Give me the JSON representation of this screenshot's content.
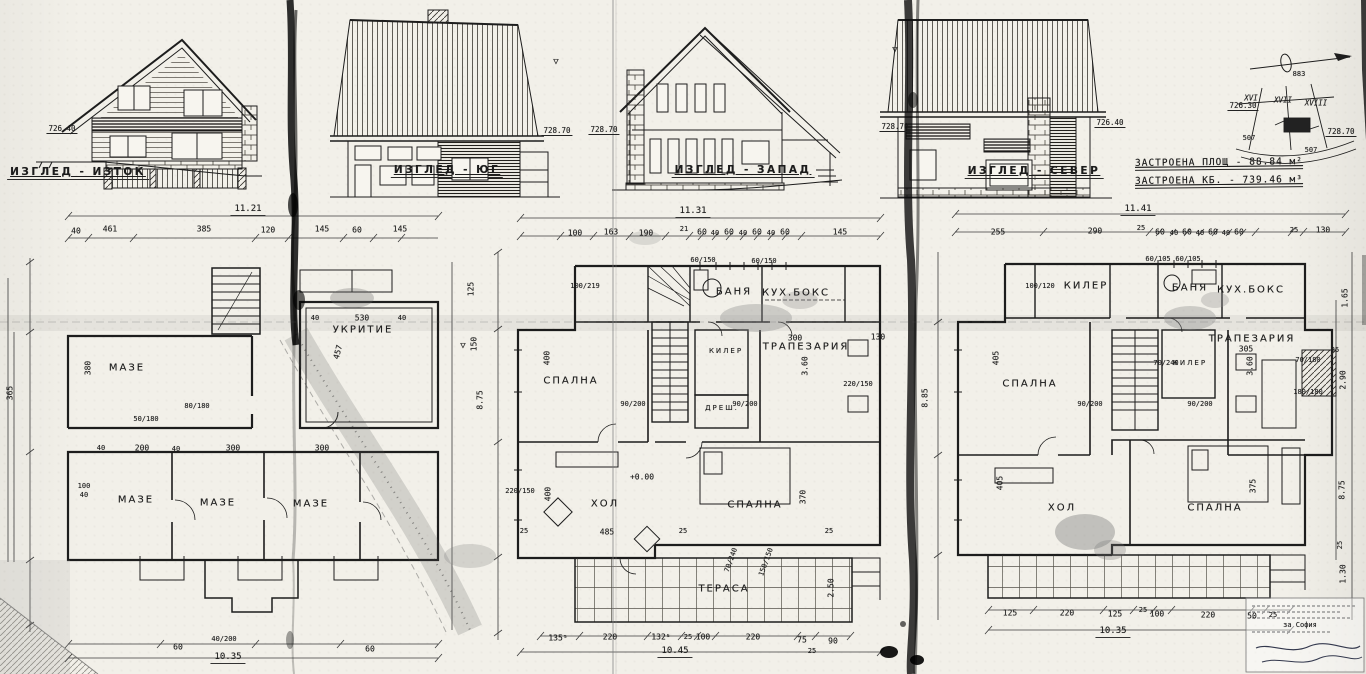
{
  "site_info": {
    "area_line": "ЗАСТРОЕНА ПЛОЩ - 88.84 м²",
    "volume_line": "ЗАСТРОЕНА КБ. - 739.46 м³"
  },
  "ink": "#1b1b1b",
  "labels": [
    {
      "t": "ИЗГЛЕД - ИЗТОК",
      "x": 78,
      "y": 173,
      "k": "view",
      "n": "view-label-east"
    },
    {
      "t": "ИЗГЛЕД - ЮГ",
      "x": 447,
      "y": 171,
      "k": "view",
      "n": "view-label-south"
    },
    {
      "t": "ИЗГЛЕД - ЗАПАД",
      "x": 743,
      "y": 171,
      "k": "view",
      "n": "view-label-west"
    },
    {
      "t": "ИЗГЛЕД - СЕВЕР",
      "x": 1034,
      "y": 172,
      "k": "view",
      "n": "view-label-north"
    },
    {
      "t": "726.40",
      "x": 62,
      "y": 129,
      "k": "lvl",
      "n": "level-mark"
    },
    {
      "t": "728.70",
      "x": 557,
      "y": 131,
      "k": "lvl",
      "n": "level-mark"
    },
    {
      "t": "728.70",
      "x": 604,
      "y": 130,
      "k": "lvl",
      "n": "level-mark"
    },
    {
      "t": "728.70",
      "x": 895,
      "y": 127,
      "k": "lvl",
      "n": "level-mark"
    },
    {
      "t": "726.40",
      "x": 1110,
      "y": 123,
      "k": "lvl",
      "n": "level-mark"
    },
    {
      "t": "726.30",
      "x": 1243,
      "y": 106,
      "k": "lvl",
      "n": "level-mark"
    },
    {
      "t": "728.70",
      "x": 1341,
      "y": 132,
      "k": "lvl",
      "n": "level-mark"
    },
    {
      "t": "▽",
      "x": 556,
      "y": 62,
      "k": "sym",
      "n": "level-symbol"
    },
    {
      "t": "▽",
      "x": 895,
      "y": 50,
      "k": "sym",
      "n": "level-symbol"
    },
    {
      "t": "▽",
      "x": 463,
      "y": 346,
      "k": "sym",
      "n": "level-symbol"
    },
    {
      "t": "XVI",
      "x": 1251,
      "y": 98,
      "k": "parcel",
      "n": "parcel-number"
    },
    {
      "t": "XVII",
      "x": 1283,
      "y": 100,
      "k": "parcel",
      "n": "parcel-number"
    },
    {
      "t": "XVIII",
      "x": 1316,
      "y": 103,
      "k": "parcel",
      "n": "parcel-number"
    },
    {
      "t": "883",
      "x": 1299,
      "y": 74,
      "k": "tiny",
      "n": "site-number"
    },
    {
      "t": "507",
      "x": 1249,
      "y": 138,
      "k": "tiny",
      "n": "plot-number"
    },
    {
      "t": "507",
      "x": 1311,
      "y": 150,
      "k": "tiny",
      "n": "plot-number"
    },
    {
      "t": "МАЗЕ",
      "x": 127,
      "y": 368,
      "k": "room",
      "n": "room-label"
    },
    {
      "t": "МАЗЕ",
      "x": 136,
      "y": 500,
      "k": "room",
      "n": "room-label"
    },
    {
      "t": "МАЗЕ",
      "x": 218,
      "y": 503,
      "k": "room",
      "n": "room-label"
    },
    {
      "t": "МАЗЕ",
      "x": 311,
      "y": 504,
      "k": "room",
      "n": "room-label"
    },
    {
      "t": "УКРИТИЕ",
      "x": 363,
      "y": 330,
      "k": "room",
      "n": "room-label"
    },
    {
      "t": "СПАЛНА",
      "x": 571,
      "y": 381,
      "k": "room",
      "n": "room-label"
    },
    {
      "t": "БАНЯ",
      "x": 734,
      "y": 292,
      "k": "room",
      "n": "room-label"
    },
    {
      "t": "КУХ.БОКС",
      "x": 796,
      "y": 293,
      "k": "room",
      "n": "room-label"
    },
    {
      "t": "ТРАПЕЗАРИЯ",
      "x": 806,
      "y": 347,
      "k": "room",
      "n": "room-label"
    },
    {
      "t": "КИЛЕР",
      "x": 726,
      "y": 351,
      "s": 7,
      "k": "room",
      "n": "room-label"
    },
    {
      "t": "ДРЕШ.",
      "x": 722,
      "y": 408,
      "s": 7,
      "k": "room",
      "n": "room-label"
    },
    {
      "t": "ХОЛ",
      "x": 605,
      "y": 504,
      "k": "room",
      "n": "room-label"
    },
    {
      "t": "СПАЛНА",
      "x": 755,
      "y": 505,
      "k": "room",
      "n": "room-label"
    },
    {
      "t": "ТЕРАСА",
      "x": 724,
      "y": 589,
      "k": "room",
      "n": "room-label"
    },
    {
      "t": "+0.00",
      "x": 642,
      "y": 477,
      "k": "dim",
      "n": "elevation-mark"
    },
    {
      "t": "КИЛЕР",
      "x": 1086,
      "y": 286,
      "k": "room",
      "n": "room-label"
    },
    {
      "t": "БАНЯ",
      "x": 1190,
      "y": 288,
      "k": "room",
      "n": "room-label"
    },
    {
      "t": "КУХ.БОКС",
      "x": 1251,
      "y": 290,
      "k": "room",
      "n": "room-label"
    },
    {
      "t": "СПАЛНА",
      "x": 1030,
      "y": 384,
      "k": "room",
      "n": "room-label"
    },
    {
      "t": "ТРАПЕЗАРИЯ",
      "x": 1252,
      "y": 339,
      "k": "room",
      "n": "room-label"
    },
    {
      "t": "КИЛЕР",
      "x": 1190,
      "y": 363,
      "s": 7,
      "k": "room",
      "n": "room-label"
    },
    {
      "t": "ХОЛ",
      "x": 1062,
      "y": 508,
      "k": "room",
      "n": "room-label"
    },
    {
      "t": "СПАЛНА",
      "x": 1215,
      "y": 508,
      "k": "room",
      "n": "room-label"
    },
    {
      "t": "11.21",
      "x": 248,
      "y": 210,
      "k": "total",
      "n": "overall-dim"
    },
    {
      "t": "10.35",
      "x": 228,
      "y": 658,
      "k": "total",
      "n": "overall-dim"
    },
    {
      "t": "11.31",
      "x": 693,
      "y": 212,
      "k": "total",
      "n": "overall-dim"
    },
    {
      "t": "10.45",
      "x": 675,
      "y": 652,
      "k": "total",
      "n": "overall-dim"
    },
    {
      "t": "11.41",
      "x": 1138,
      "y": 210,
      "k": "total",
      "n": "overall-dim"
    },
    {
      "t": "10.35",
      "x": 1113,
      "y": 632,
      "k": "total",
      "n": "overall-dim"
    },
    {
      "t": "40",
      "x": 76,
      "y": 231,
      "k": "dim",
      "n": "dim"
    },
    {
      "t": "461",
      "x": 110,
      "y": 229,
      "k": "dim",
      "n": "dim"
    },
    {
      "t": "385",
      "x": 204,
      "y": 229,
      "k": "dim",
      "n": "dim"
    },
    {
      "t": "120",
      "x": 268,
      "y": 230,
      "k": "dim",
      "n": "dim"
    },
    {
      "t": "145",
      "x": 322,
      "y": 229,
      "k": "dim",
      "n": "dim"
    },
    {
      "t": "60",
      "x": 357,
      "y": 230,
      "k": "dim",
      "n": "dim"
    },
    {
      "t": "145",
      "x": 400,
      "y": 229,
      "k": "dim",
      "n": "dim"
    },
    {
      "t": "365",
      "x": 10,
      "y": 393,
      "r": -90,
      "k": "dim",
      "n": "dim"
    },
    {
      "t": "380",
      "x": 88,
      "y": 368,
      "r": -90,
      "k": "dim",
      "n": "dim"
    },
    {
      "t": "100",
      "x": 84,
      "y": 486,
      "s": 7,
      "k": "dim",
      "n": "dim"
    },
    {
      "t": "40",
      "x": 84,
      "y": 495,
      "s": 7,
      "k": "dim",
      "n": "dim"
    },
    {
      "t": "40",
      "x": 101,
      "y": 448,
      "s": 7,
      "k": "dim",
      "n": "dim"
    },
    {
      "t": "200",
      "x": 142,
      "y": 448,
      "k": "dim",
      "n": "dim"
    },
    {
      "t": "40",
      "x": 176,
      "y": 449,
      "s": 7,
      "k": "dim",
      "n": "dim"
    },
    {
      "t": "300",
      "x": 233,
      "y": 448,
      "k": "dim",
      "n": "dim"
    },
    {
      "t": "300",
      "x": 322,
      "y": 448,
      "k": "dim",
      "n": "dim"
    },
    {
      "t": "80/180",
      "x": 197,
      "y": 406,
      "k": "frac",
      "n": "dim"
    },
    {
      "t": "50/180",
      "x": 146,
      "y": 419,
      "k": "frac",
      "n": "dim"
    },
    {
      "t": "457",
      "x": 338,
      "y": 352,
      "r": -75,
      "k": "dim",
      "n": "dim"
    },
    {
      "t": "40",
      "x": 315,
      "y": 318,
      "s": 7,
      "k": "dim",
      "n": "dim"
    },
    {
      "t": "530",
      "x": 362,
      "y": 318,
      "k": "dim",
      "n": "dim"
    },
    {
      "t": "40",
      "x": 402,
      "y": 318,
      "s": 7,
      "k": "dim",
      "n": "dim"
    },
    {
      "t": "125",
      "x": 471,
      "y": 289,
      "r": -90,
      "k": "dim",
      "n": "dim"
    },
    {
      "t": "150",
      "x": 474,
      "y": 344,
      "r": -90,
      "k": "dim",
      "n": "dim"
    },
    {
      "t": "60",
      "x": 178,
      "y": 647,
      "k": "dim",
      "n": "dim"
    },
    {
      "t": "40/200",
      "x": 224,
      "y": 639,
      "k": "frac",
      "n": "dim"
    },
    {
      "t": "60",
      "x": 370,
      "y": 649,
      "k": "dim",
      "n": "dim"
    },
    {
      "t": "100",
      "x": 575,
      "y": 233,
      "k": "dim",
      "n": "dim"
    },
    {
      "t": "163",
      "x": 611,
      "y": 232,
      "k": "dim",
      "n": "dim"
    },
    {
      "t": "190",
      "x": 646,
      "y": 233,
      "k": "dim",
      "n": "dim"
    },
    {
      "t": "21",
      "x": 684,
      "y": 229,
      "s": 7,
      "k": "dim",
      "n": "dim"
    },
    {
      "t": "60",
      "x": 702,
      "y": 232,
      "k": "dim",
      "n": "dim"
    },
    {
      "t": "40",
      "x": 715,
      "y": 233,
      "s": 7,
      "k": "dim",
      "n": "dim"
    },
    {
      "t": "60",
      "x": 729,
      "y": 232,
      "k": "dim",
      "n": "dim"
    },
    {
      "t": "40",
      "x": 743,
      "y": 233,
      "s": 7,
      "k": "dim",
      "n": "dim"
    },
    {
      "t": "60",
      "x": 757,
      "y": 232,
      "k": "dim",
      "n": "dim"
    },
    {
      "t": "40",
      "x": 771,
      "y": 233,
      "s": 7,
      "k": "dim",
      "n": "dim"
    },
    {
      "t": "60",
      "x": 785,
      "y": 232,
      "k": "dim",
      "n": "dim"
    },
    {
      "t": "145",
      "x": 840,
      "y": 232,
      "k": "dim",
      "n": "dim"
    },
    {
      "t": "8.75",
      "x": 480,
      "y": 400,
      "r": -90,
      "k": "dim",
      "n": "dim"
    },
    {
      "t": "100/219",
      "x": 585,
      "y": 286,
      "k": "frac",
      "n": "dim"
    },
    {
      "t": "400",
      "x": 547,
      "y": 358,
      "r": -90,
      "k": "dim",
      "n": "dim"
    },
    {
      "t": "300",
      "x": 795,
      "y": 338,
      "k": "dim",
      "n": "dim"
    },
    {
      "t": "130",
      "x": 878,
      "y": 337,
      "k": "dim",
      "n": "dim"
    },
    {
      "t": "220/150",
      "x": 858,
      "y": 384,
      "k": "frac",
      "n": "dim"
    },
    {
      "t": "3.60",
      "x": 805,
      "y": 366,
      "r": -90,
      "k": "dim",
      "n": "dim"
    },
    {
      "t": "90/200",
      "x": 633,
      "y": 404,
      "k": "frac",
      "n": "dim"
    },
    {
      "t": "90/200",
      "x": 745,
      "y": 404,
      "k": "frac",
      "n": "dim"
    },
    {
      "t": "220/150",
      "x": 520,
      "y": 491,
      "k": "frac",
      "n": "dim"
    },
    {
      "t": "400",
      "x": 548,
      "y": 494,
      "r": -90,
      "k": "dim",
      "n": "dim"
    },
    {
      "t": "485",
      "x": 607,
      "y": 532,
      "k": "dim",
      "n": "dim"
    },
    {
      "t": "25",
      "x": 524,
      "y": 531,
      "s": 7,
      "k": "dim",
      "n": "dim"
    },
    {
      "t": "25",
      "x": 683,
      "y": 531,
      "s": 7,
      "k": "dim",
      "n": "dim"
    },
    {
      "t": "25",
      "x": 829,
      "y": 531,
      "s": 7,
      "k": "dim",
      "n": "dim"
    },
    {
      "t": "370",
      "x": 803,
      "y": 497,
      "r": -90,
      "k": "dim",
      "n": "dim"
    },
    {
      "t": "2.50",
      "x": 831,
      "y": 588,
      "r": -90,
      "k": "dim",
      "n": "dim"
    },
    {
      "t": "70/240",
      "x": 731,
      "y": 560,
      "r": -70,
      "k": "frac",
      "n": "dim"
    },
    {
      "t": "150/150",
      "x": 766,
      "y": 562,
      "r": -70,
      "k": "frac",
      "n": "dim"
    },
    {
      "t": "60/150",
      "x": 703,
      "y": 260,
      "k": "frac",
      "n": "dim"
    },
    {
      "t": "60/150",
      "x": 764,
      "y": 261,
      "k": "frac",
      "n": "dim"
    },
    {
      "t": "135⁵",
      "x": 558,
      "y": 638,
      "k": "dim",
      "n": "dim"
    },
    {
      "t": "220",
      "x": 610,
      "y": 637,
      "k": "dim",
      "n": "dim"
    },
    {
      "t": "132⁵",
      "x": 661,
      "y": 637,
      "k": "dim",
      "n": "dim"
    },
    {
      "t": "25",
      "x": 688,
      "y": 637,
      "s": 7,
      "k": "dim",
      "n": "dim"
    },
    {
      "t": "100",
      "x": 703,
      "y": 637,
      "k": "dim",
      "n": "dim"
    },
    {
      "t": "220",
      "x": 753,
      "y": 637,
      "k": "dim",
      "n": "dim"
    },
    {
      "t": "75",
      "x": 802,
      "y": 640,
      "k": "dim",
      "n": "dim"
    },
    {
      "t": "90",
      "x": 833,
      "y": 641,
      "k": "dim",
      "n": "dim"
    },
    {
      "t": "25",
      "x": 812,
      "y": 651,
      "s": 7,
      "k": "dim",
      "n": "dim"
    },
    {
      "t": "255",
      "x": 998,
      "y": 232,
      "k": "dim",
      "n": "dim"
    },
    {
      "t": "290",
      "x": 1095,
      "y": 231,
      "k": "dim",
      "n": "dim"
    },
    {
      "t": "25",
      "x": 1141,
      "y": 228,
      "s": 7,
      "k": "dim",
      "n": "dim"
    },
    {
      "t": "60",
      "x": 1160,
      "y": 232,
      "k": "dim",
      "n": "dim"
    },
    {
      "t": "40",
      "x": 1174,
      "y": 233,
      "s": 7,
      "k": "dim",
      "n": "dim"
    },
    {
      "t": "60",
      "x": 1187,
      "y": 232,
      "k": "dim",
      "n": "dim"
    },
    {
      "t": "40",
      "x": 1200,
      "y": 233,
      "s": 7,
      "k": "dim",
      "n": "dim"
    },
    {
      "t": "60",
      "x": 1213,
      "y": 232,
      "k": "dim",
      "n": "dim"
    },
    {
      "t": "40",
      "x": 1226,
      "y": 233,
      "s": 7,
      "k": "dim",
      "n": "dim"
    },
    {
      "t": "60",
      "x": 1239,
      "y": 232,
      "k": "dim",
      "n": "dim"
    },
    {
      "t": "25",
      "x": 1294,
      "y": 230,
      "s": 7,
      "k": "dim",
      "n": "dim"
    },
    {
      "t": "130",
      "x": 1323,
      "y": 230,
      "k": "dim",
      "n": "dim"
    },
    {
      "t": "8.85",
      "x": 925,
      "y": 398,
      "r": -90,
      "k": "dim",
      "n": "dim"
    },
    {
      "t": "405",
      "x": 996,
      "y": 358,
      "r": -90,
      "k": "dim",
      "n": "dim"
    },
    {
      "t": "405",
      "x": 1000,
      "y": 483,
      "r": -90,
      "k": "dim",
      "n": "dim"
    },
    {
      "t": "100/120",
      "x": 1040,
      "y": 286,
      "k": "frac",
      "n": "dim"
    },
    {
      "t": "70/180",
      "x": 1308,
      "y": 360,
      "k": "frac",
      "n": "dim"
    },
    {
      "t": "305",
      "x": 1246,
      "y": 349,
      "k": "dim",
      "n": "dim"
    },
    {
      "t": "25",
      "x": 1335,
      "y": 350,
      "s": 7,
      "k": "dim",
      "n": "dim"
    },
    {
      "t": "3.60",
      "x": 1250,
      "y": 366,
      "r": -90,
      "k": "dim",
      "n": "dim"
    },
    {
      "t": "90/200",
      "x": 1090,
      "y": 404,
      "k": "frac",
      "n": "dim"
    },
    {
      "t": "90/200",
      "x": 1200,
      "y": 404,
      "k": "frac",
      "n": "dim"
    },
    {
      "t": "70/240",
      "x": 1166,
      "y": 363,
      "k": "frac",
      "n": "dim"
    },
    {
      "t": "180/180",
      "x": 1308,
      "y": 392,
      "k": "frac",
      "n": "dim"
    },
    {
      "t": "375",
      "x": 1253,
      "y": 486,
      "r": -90,
      "k": "dim",
      "n": "dim"
    },
    {
      "t": "1.65",
      "x": 1345,
      "y": 298,
      "r": -90,
      "k": "dim",
      "n": "dim"
    },
    {
      "t": "2.90",
      "x": 1343,
      "y": 380,
      "r": -90,
      "k": "dim",
      "n": "dim"
    },
    {
      "t": "8.75",
      "x": 1342,
      "y": 490,
      "r": -90,
      "k": "dim",
      "n": "dim"
    },
    {
      "t": "1.30",
      "x": 1343,
      "y": 574,
      "r": -90,
      "k": "dim",
      "n": "dim"
    },
    {
      "t": "25",
      "x": 1340,
      "y": 545,
      "r": -90,
      "s": 7,
      "k": "dim",
      "n": "dim"
    },
    {
      "t": "60/105",
      "x": 1158,
      "y": 259,
      "k": "frac",
      "n": "dim"
    },
    {
      "t": "60/105",
      "x": 1188,
      "y": 259,
      "k": "frac",
      "n": "dim"
    },
    {
      "t": "125",
      "x": 1010,
      "y": 613,
      "k": "dim",
      "n": "dim"
    },
    {
      "t": "220",
      "x": 1067,
      "y": 613,
      "k": "dim",
      "n": "dim"
    },
    {
      "t": "125",
      "x": 1115,
      "y": 614,
      "k": "dim",
      "n": "dim"
    },
    {
      "t": "25",
      "x": 1143,
      "y": 610,
      "s": 7,
      "k": "dim",
      "n": "dim"
    },
    {
      "t": "100",
      "x": 1157,
      "y": 614,
      "k": "dim",
      "n": "dim"
    },
    {
      "t": "220",
      "x": 1208,
      "y": 615,
      "k": "dim",
      "n": "dim"
    },
    {
      "t": "50",
      "x": 1252,
      "y": 616,
      "k": "dim",
      "n": "dim"
    },
    {
      "t": "25",
      "x": 1273,
      "y": 615,
      "s": 7,
      "k": "dim",
      "n": "dim"
    },
    {
      "t": "за София",
      "x": 1300,
      "y": 625,
      "k": "tiny",
      "n": "stamp-text"
    }
  ]
}
